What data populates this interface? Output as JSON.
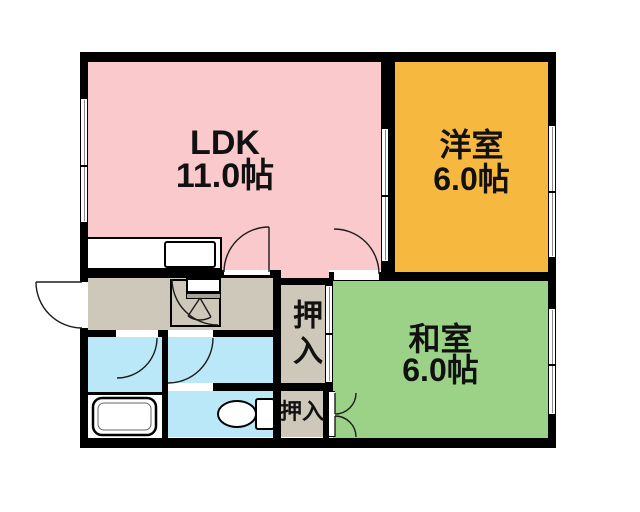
{
  "floor_plan_title": "apartment-floor-plan",
  "rooms": {
    "ldk": {
      "name": "LDK",
      "size": "11.0帖"
    },
    "western": {
      "name": "洋室",
      "size": "6.0帖"
    },
    "japanese": {
      "name": "和室",
      "size": "6.0帖"
    },
    "closet_large": {
      "name": "押入"
    },
    "closet_small": {
      "name": "押入"
    }
  },
  "icons": {
    "bathtub": "bathtub-icon",
    "toilet": "toilet-icon",
    "kitchen_sink": "kitchen-sink-icon",
    "doors": "door-swing-arc-icon",
    "windows": "sliding-window-icon"
  },
  "colors": {
    "ldk_pink": "#fac9cb",
    "western_orange": "#f7b840",
    "japanese_green": "#9bd288",
    "water_blue": "#bbe8f9",
    "hall_gray": "#cec8ba",
    "cabinet_gray": "#a9a396",
    "wall_black": "#000000"
  }
}
